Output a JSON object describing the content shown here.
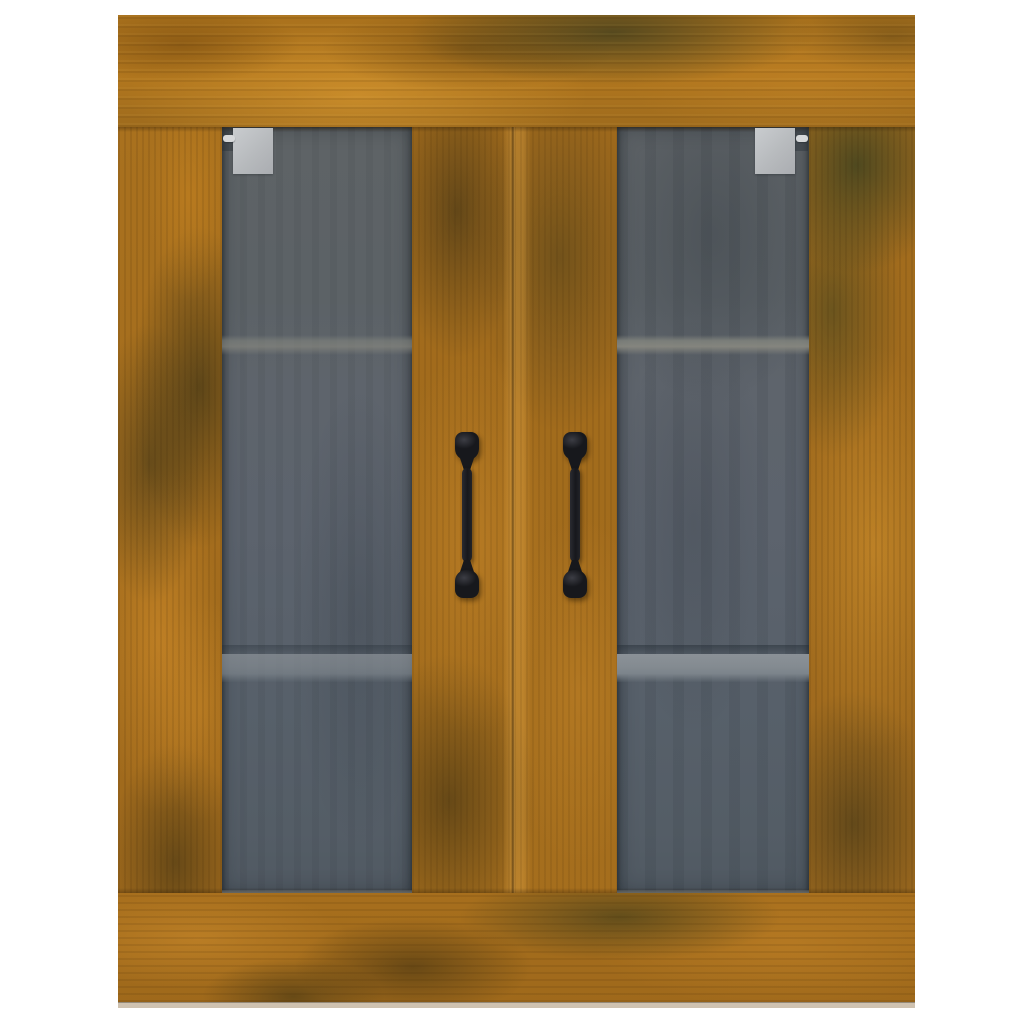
{
  "image": {
    "kind": "product photo on plain white background",
    "subject": "Wall-mounted hanging cabinet with two glass doors",
    "finish": "rustic smoked-oak style wood with mottled orange, brown and dark olive patches",
    "text_content": "none"
  },
  "cabinet": {
    "frame": {
      "top_rail": "horizontal wood plank header",
      "bottom_rail": "horizontal wood plank base",
      "left_stile": "vertical wood plank",
      "center_stiles": "two adjoining vertical wood planks with a faint door gap",
      "right_stile": "vertical wood plank"
    },
    "doors": [
      {
        "side": "left",
        "glass": "dark tinted glass panel",
        "handle": "black vertical pull handle",
        "hinge_plate": "silver corner plate at top inner corner of glass"
      },
      {
        "side": "right",
        "glass": "dark tinted glass panel",
        "handle": "black vertical pull handle",
        "hinge_plate": "silver corner plate at top inner corner of glass"
      }
    ],
    "interior": {
      "shelves_visible_through_glass": 2,
      "upper_shelf": "thin light gray band in upper third",
      "lower_shelf": "wider light gray band with shadow line in lower third"
    },
    "handles_count": 2,
    "hinge_plates_count": 2
  },
  "colors": {
    "background": "#ffffff",
    "wood_base": "#a56e1d",
    "wood_bright": "#c8892b",
    "wood_dark": "#5f4a16",
    "wood_olive": "#4d4a22",
    "glass_base": "#5c636a",
    "glass_dark": "#515a63",
    "shelf_upper": "#828580",
    "shelf_lower": "#868d93",
    "shelf_shadow": "#47505a",
    "handle_black": "#17181c",
    "hinge_plate": "#b7babd",
    "hinge_pin": "#d6d8da",
    "bottom_edge_strip": "#cfc2b0"
  }
}
